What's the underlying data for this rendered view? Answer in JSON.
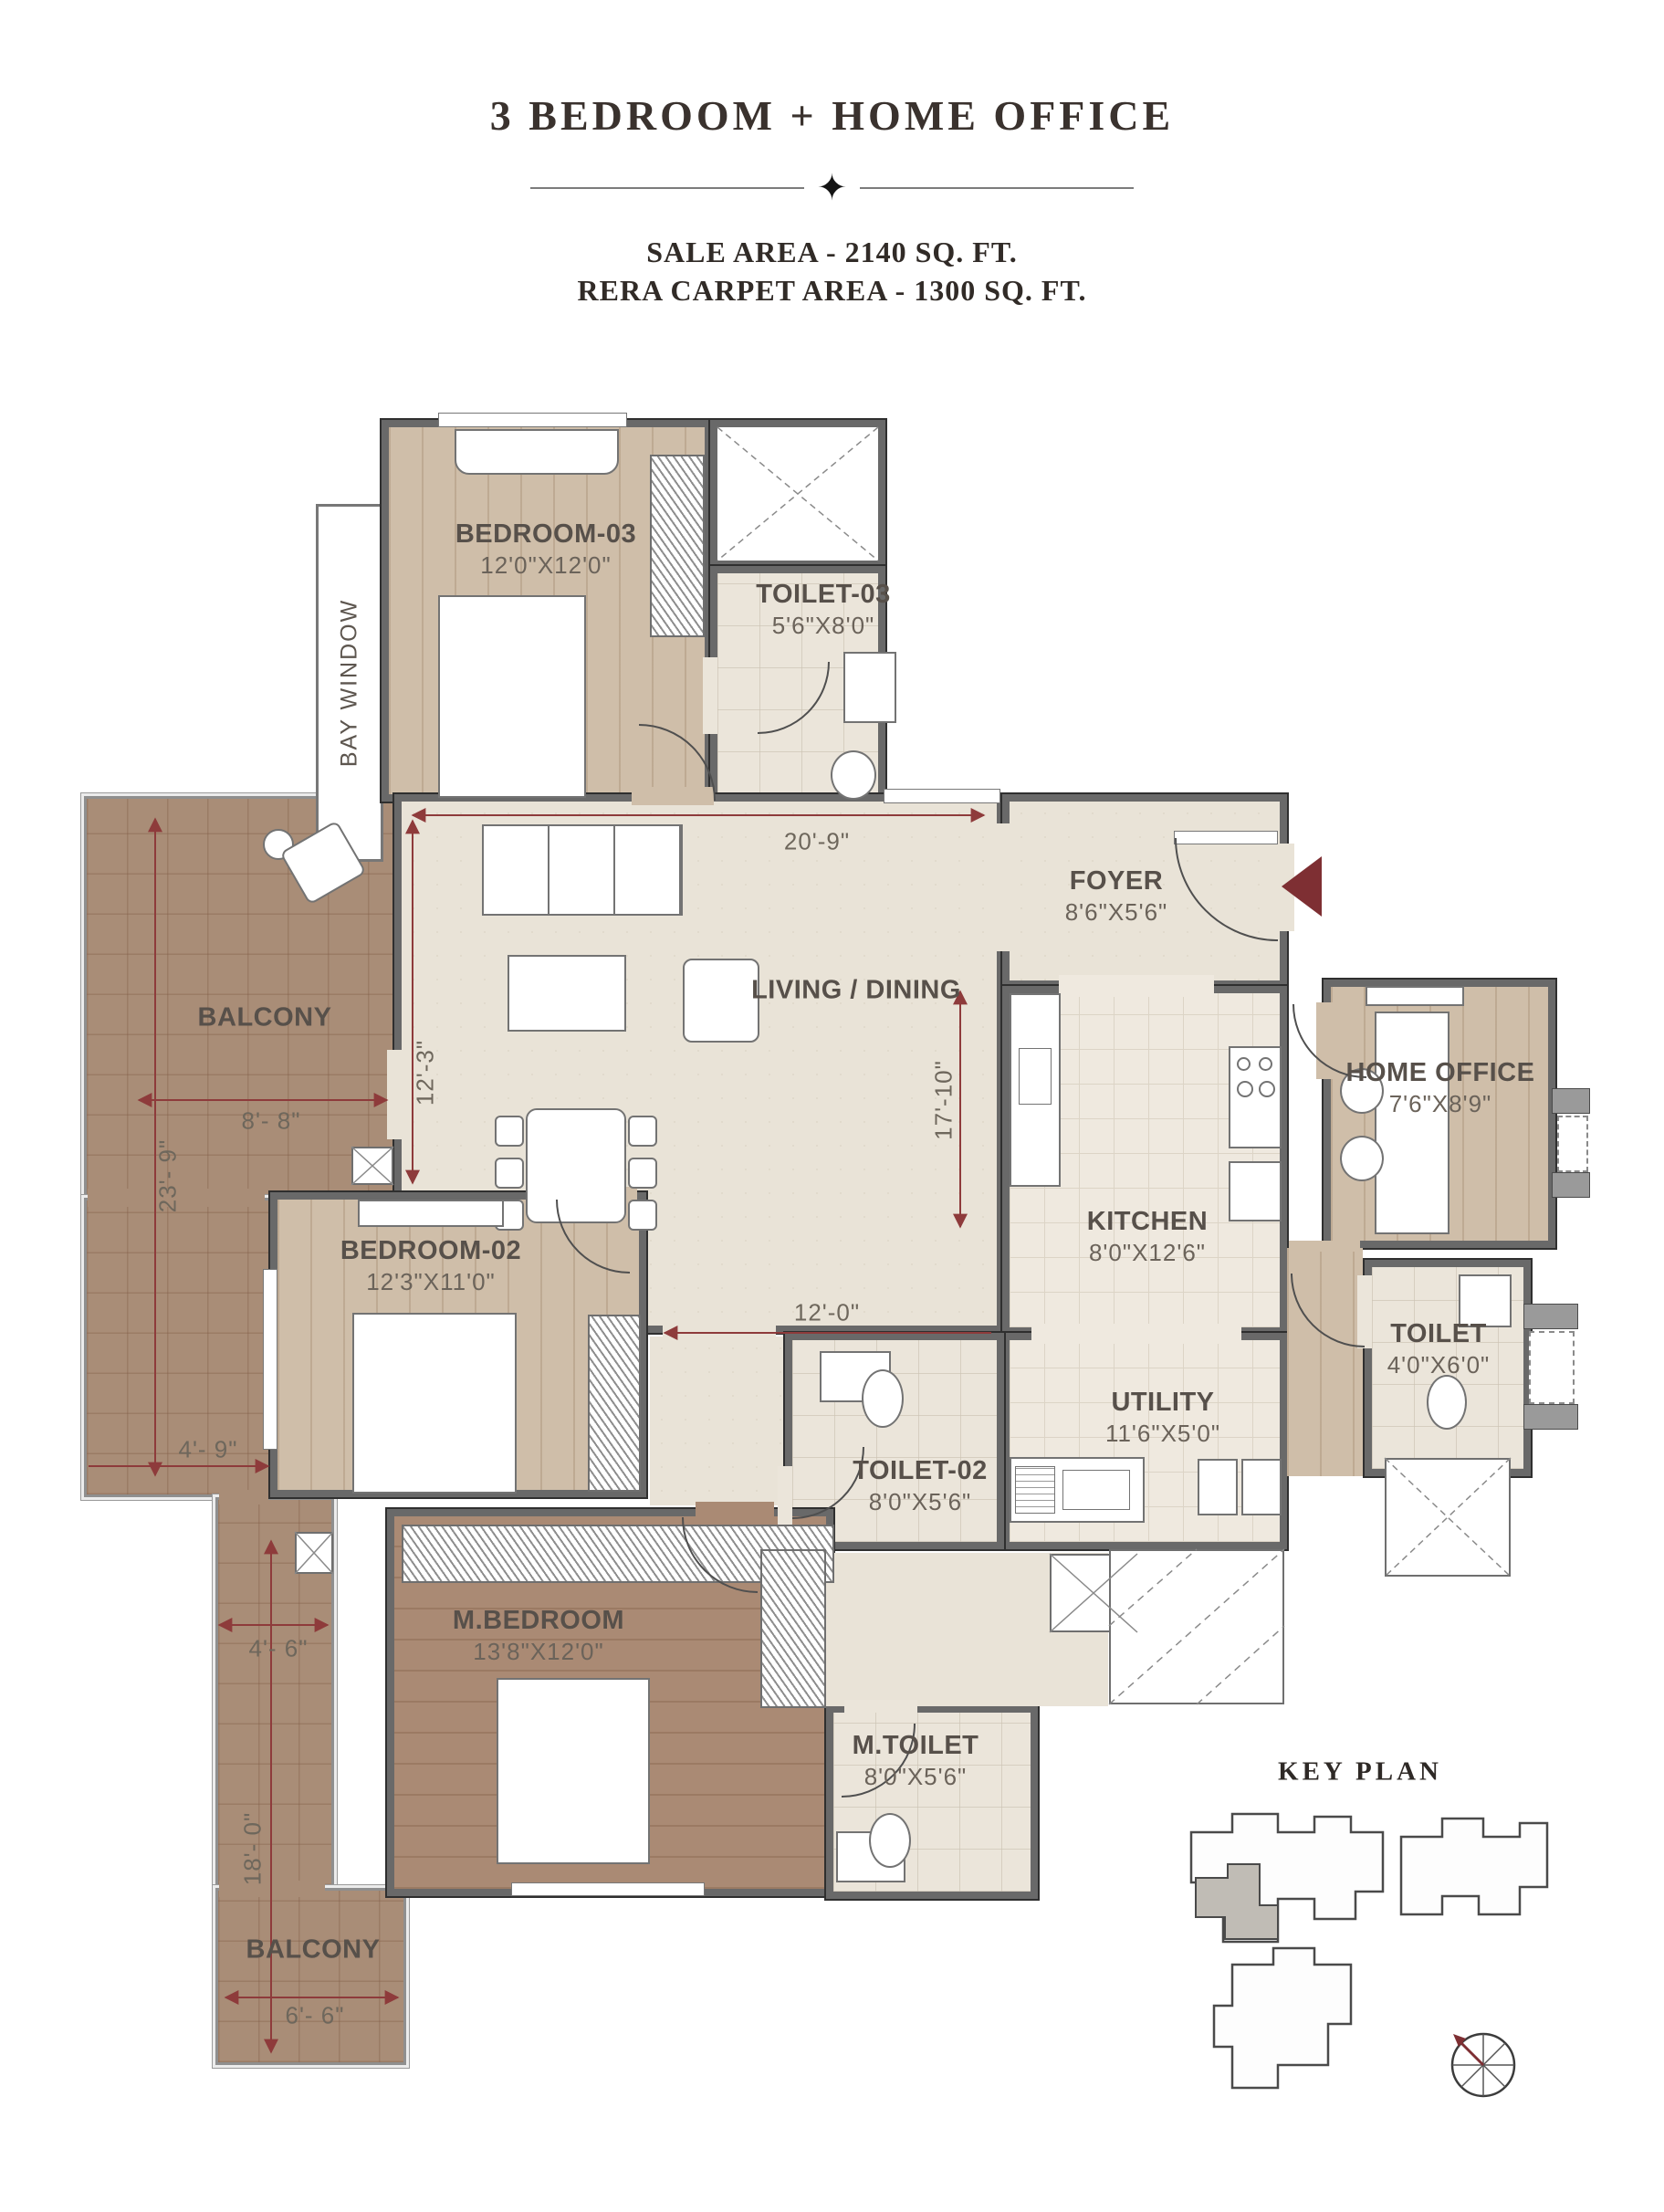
{
  "header": {
    "title": "3 BEDROOM + HOME OFFICE",
    "sale_area": "SALE AREA - 2140 SQ. FT.",
    "rera_area": "RERA CARPET AREA - 1300 SQ. FT."
  },
  "rooms": {
    "bedroom3": {
      "name": "BEDROOM-03",
      "size": "12'0\"X12'0\""
    },
    "toilet3": {
      "name": "TOILET-03",
      "size": "5'6\"X8'0\""
    },
    "bay_window": {
      "name": "BAY WINDOW"
    },
    "balcony_left": {
      "name": "BALCONY"
    },
    "living": {
      "name": "LIVING / DINING"
    },
    "foyer": {
      "name": "FOYER",
      "size": "8'6\"X5'6\""
    },
    "home_office": {
      "name": "HOME OFFICE",
      "size": "7'6\"X8'9\""
    },
    "kitchen": {
      "name": "KITCHEN",
      "size": "8'0\"X12'6\""
    },
    "toilet": {
      "name": "TOILET",
      "size": "4'0\"X6'0\""
    },
    "utility": {
      "name": "UTILITY",
      "size": "11'6\"X5'0\""
    },
    "bedroom2": {
      "name": "BEDROOM-02",
      "size": "12'3\"X11'0\""
    },
    "toilet2": {
      "name": "TOILET-02",
      "size": "8'0\"X5'6\""
    },
    "mbedroom": {
      "name": "M.BEDROOM",
      "size": "13'8\"X12'0\""
    },
    "mtoilet": {
      "name": "M.TOILET",
      "size": "8'0\"X5'6\""
    },
    "balcony_bottom": {
      "name": "BALCONY"
    }
  },
  "dimensions": {
    "d20_9": "20'-9\"",
    "d12_3": "12'-3\"",
    "d17_10": "17'-10\"",
    "d12_0": "12'-0\"",
    "d8_8": "8'- 8\"",
    "d23_9": "23'- 9\"",
    "d4_9": "4'- 9\"",
    "d4_6": "4'- 6\"",
    "d18_0": "18'- 0\"",
    "d6_6": "6'- 6\""
  },
  "key_plan": {
    "title": "KEY PLAN"
  },
  "icons": {
    "divider_star": "✦"
  },
  "colors": {
    "wall": "#696969",
    "wall_edge": "#2f2f2f",
    "accent_red": "#8e3b3b",
    "entry_arrow": "#7e2f33",
    "wood_light": "#cfbea9",
    "wood_dark": "#aa8a74",
    "stone": "#e9e3d7",
    "label_text": "#57504a"
  }
}
